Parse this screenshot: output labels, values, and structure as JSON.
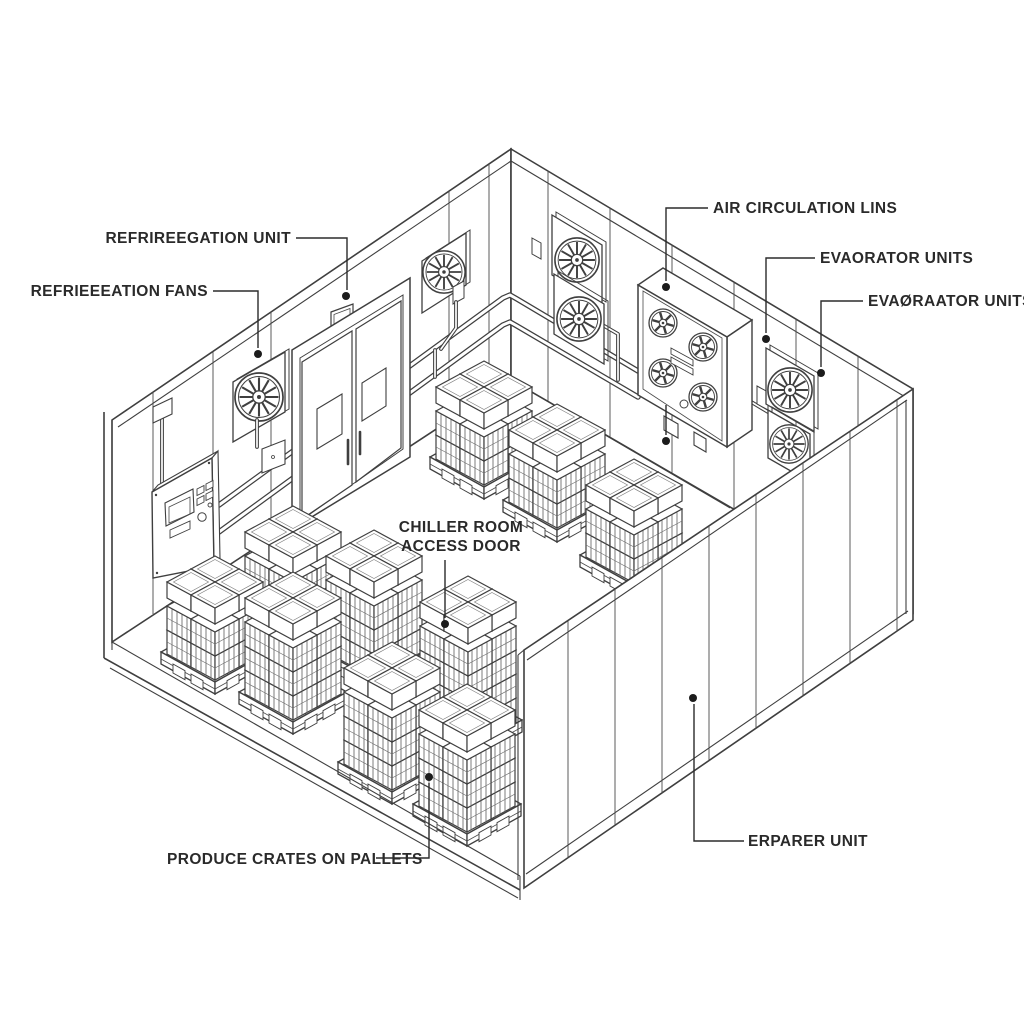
{
  "meta": {
    "scene": "isometric line diagram of a refrigerated chiller room cutaway",
    "background_color": "#ffffff",
    "line_color": "#3f3f3f",
    "label_color": "#2a2a2a",
    "leader_dot_color": "#1c1c1c"
  },
  "labels": {
    "refrigeration_unit": "REFRIREEGATION UNIT",
    "refrigeration_fans": "REFRIEEEATION FANS",
    "air_circulation_lines": "AIR CIRCULATION LINS",
    "evaporator_units_upper": "EVAORATOR UNITS",
    "evaporator_units_lower": "EVAØRAATOR UNITS",
    "chiller_room_line1": "CHILLER ROOM",
    "chiller_room_line2": "ACCESS DOOR",
    "produce_crates": "PRODUCE CRATES ON PALLETS",
    "erparer_unit": "ERPARER UNIT"
  },
  "leaders": [
    {
      "label": "refrigeration_unit",
      "points_to": "thermostat-box"
    },
    {
      "label": "refrigeration_fans",
      "points_to": "wall-fan-left"
    },
    {
      "label": "air_circulation_lines",
      "points_to": "evaporator-unit-and-piping"
    },
    {
      "label": "evaporator_units_upper",
      "points_to": "back-right-wall"
    },
    {
      "label": "evaporator_units_lower",
      "points_to": "wall-fan-right-upper"
    },
    {
      "label": "chiller_room",
      "points_to": "pallet-stack-tall"
    },
    {
      "label": "produce_crates",
      "points_to": "pallet-stack-front"
    },
    {
      "label": "erparer_unit",
      "points_to": "front-right-wall"
    }
  ],
  "equipment_icons": [
    "wall-fan-icon",
    "evaporator-unit-icon",
    "control-panel-icon",
    "double-door-icon",
    "thermostat-icon",
    "pallet-crates-icon",
    "pipe-icon"
  ]
}
